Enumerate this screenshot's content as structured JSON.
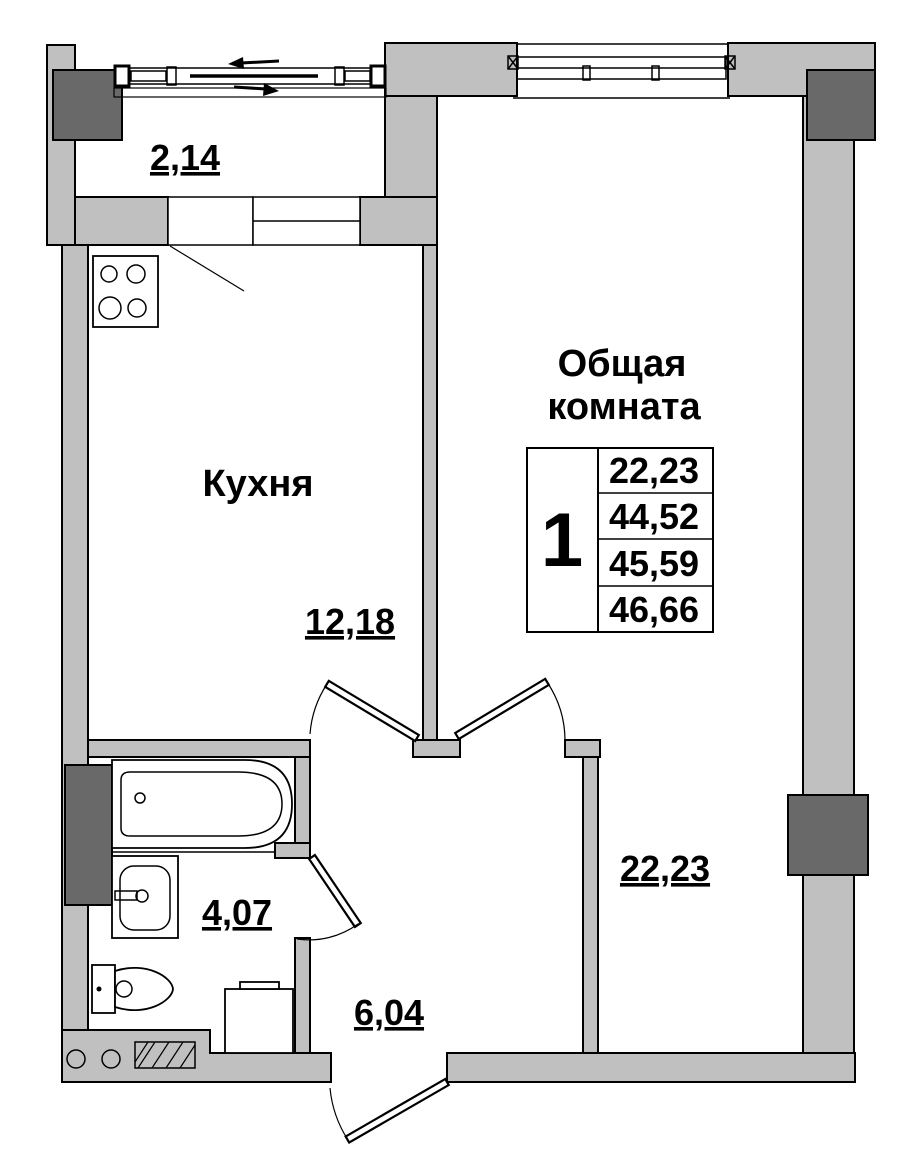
{
  "colors": {
    "wall": "#c0c0c0",
    "column": "#696969",
    "line": "#000000",
    "background": "#ffffff"
  },
  "rooms": {
    "balcony": {
      "area": "2,14"
    },
    "kitchen": {
      "name": "Кухня",
      "area": "12,18"
    },
    "living": {
      "name_line1": "Общая",
      "name_line2": "комната",
      "area": "22,23"
    },
    "bathroom": {
      "area": "4,07"
    },
    "hall": {
      "area": "6,04"
    }
  },
  "info_table": {
    "flat_number": "1",
    "areas": [
      "22,23",
      "44,52",
      "45,59",
      "46,66"
    ]
  }
}
